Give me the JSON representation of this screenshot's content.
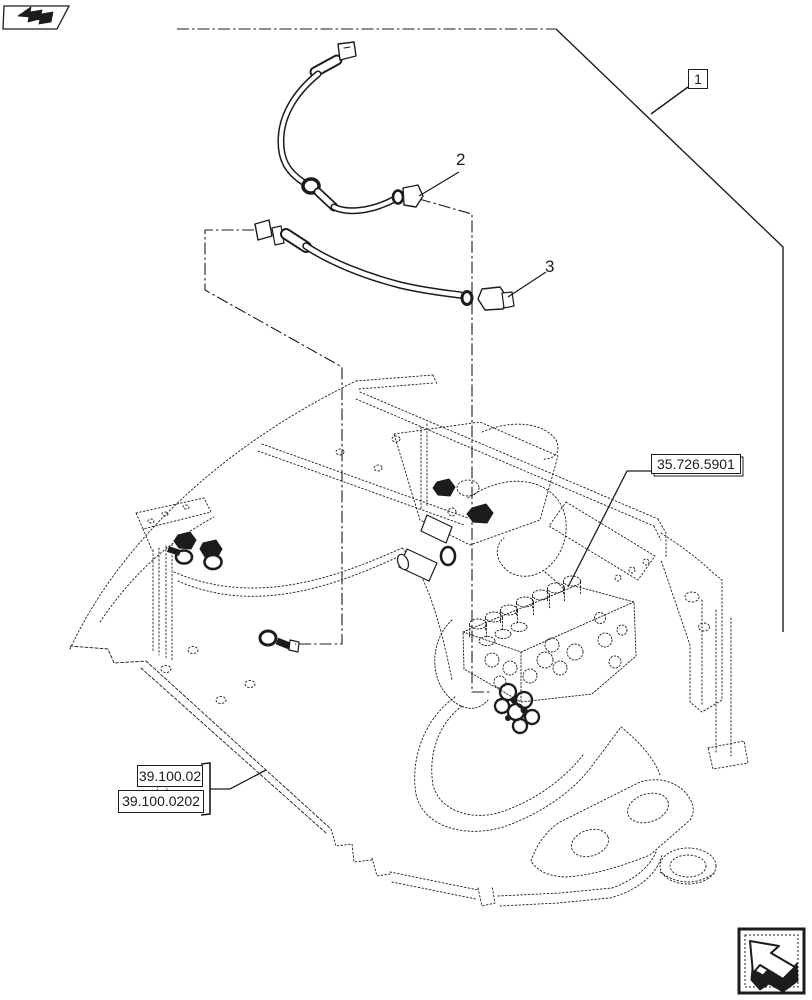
{
  "page": {
    "type": "hydraulic-parts-exploded-diagram",
    "background": "#ffffff",
    "line_color": "#1c1c1c"
  },
  "navigation": {
    "back_icon": "page-back-arrow",
    "forward_icon": "page-forward-arrow"
  },
  "callouts": {
    "item_1": "1",
    "item_2": "2",
    "item_3": "3"
  },
  "references": {
    "valve_section": "35.726.5901",
    "chassis_section": "39.100.02",
    "chassis_subsection": "39.100.0202"
  }
}
